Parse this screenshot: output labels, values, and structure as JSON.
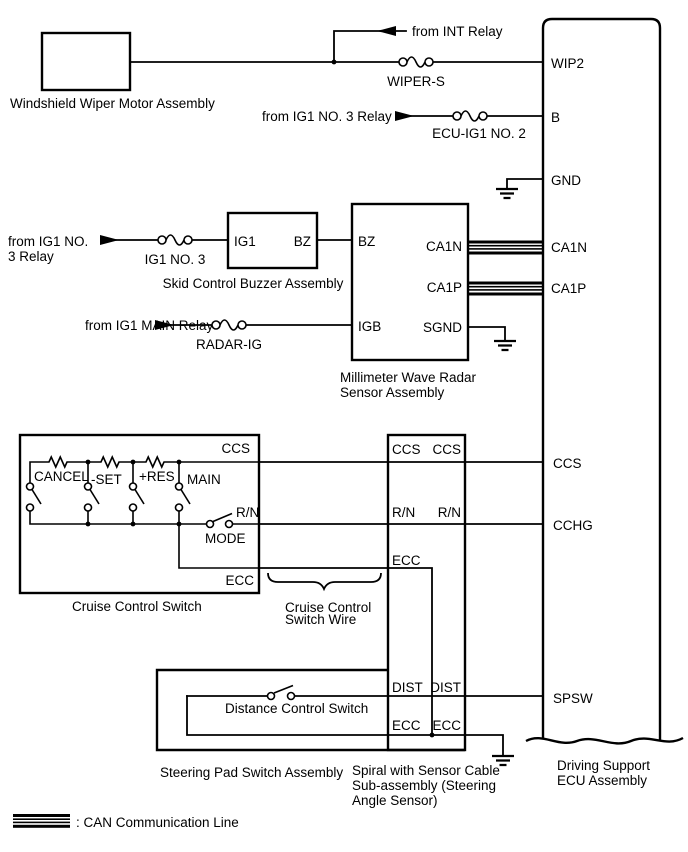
{
  "wiper_motor": {
    "label": "Windshield Wiper Motor Assembly"
  },
  "power_sources": {
    "int_relay": "from INT Relay",
    "ig1_no3_relay": "from IG1 NO. 3 Relay",
    "ig1_no3_relay_l1": "from IG1 NO.",
    "ig1_no3_relay_l2": "3 Relay",
    "ig1_main_relay": "from IG1 MAIN Relay"
  },
  "fuses": {
    "wiper_s": "WIPER-S",
    "ecu_ig1_no_2": "ECU-IG1 NO. 2",
    "ig1_no_3": "IG1 NO. 3",
    "radar_ig": "RADAR-IG"
  },
  "buzzer": {
    "label": "Skid Control Buzzer Assembly",
    "ig1": "IG1",
    "bz": "BZ"
  },
  "radar": {
    "label_l1": "Millimeter Wave Radar",
    "label_l2": "Sensor Assembly",
    "bz": "BZ",
    "ca1n": "CA1N",
    "ca1p": "CA1P",
    "igb": "IGB",
    "sgnd": "SGND"
  },
  "cruise": {
    "label": "Cruise Control Switch",
    "ccs": "CCS",
    "cancel": "CANCEL",
    "set": "-SET",
    "res": "+RES",
    "main": "MAIN",
    "rn": "R/N",
    "mode": "MODE",
    "ecc": "ECC"
  },
  "switch_wire": {
    "label_l1": "Cruise Control",
    "label_l2": "Switch Wire"
  },
  "spiral": {
    "label_l1": "Spiral with Sensor Cable",
    "label_l2": "Sub-assembly (Steering",
    "label_l3": "Angle Sensor)",
    "ccs_l": "CCS",
    "ccs_r": "CCS",
    "rn_l": "R/N",
    "rn_r": "R/N",
    "ecc": "ECC",
    "dist_l": "DIST",
    "dist_r": "DIST",
    "ecc_l": "ECC",
    "ecc_r": "ECC"
  },
  "distance_switch": {
    "label": "Distance Control Switch"
  },
  "steering_pad": {
    "label": "Steering Pad Switch Assembly"
  },
  "ecu": {
    "label_l1": "Driving Support",
    "label_l2": "ECU Assembly",
    "wip2": "WIP2",
    "b": "B",
    "gnd": "GND",
    "ca1n": "CA1N",
    "ca1p": "CA1P",
    "ccs": "CCS",
    "cchg": "CCHG",
    "spsw": "SPSW"
  },
  "legend": {
    "can_line": ": CAN Communication Line"
  }
}
